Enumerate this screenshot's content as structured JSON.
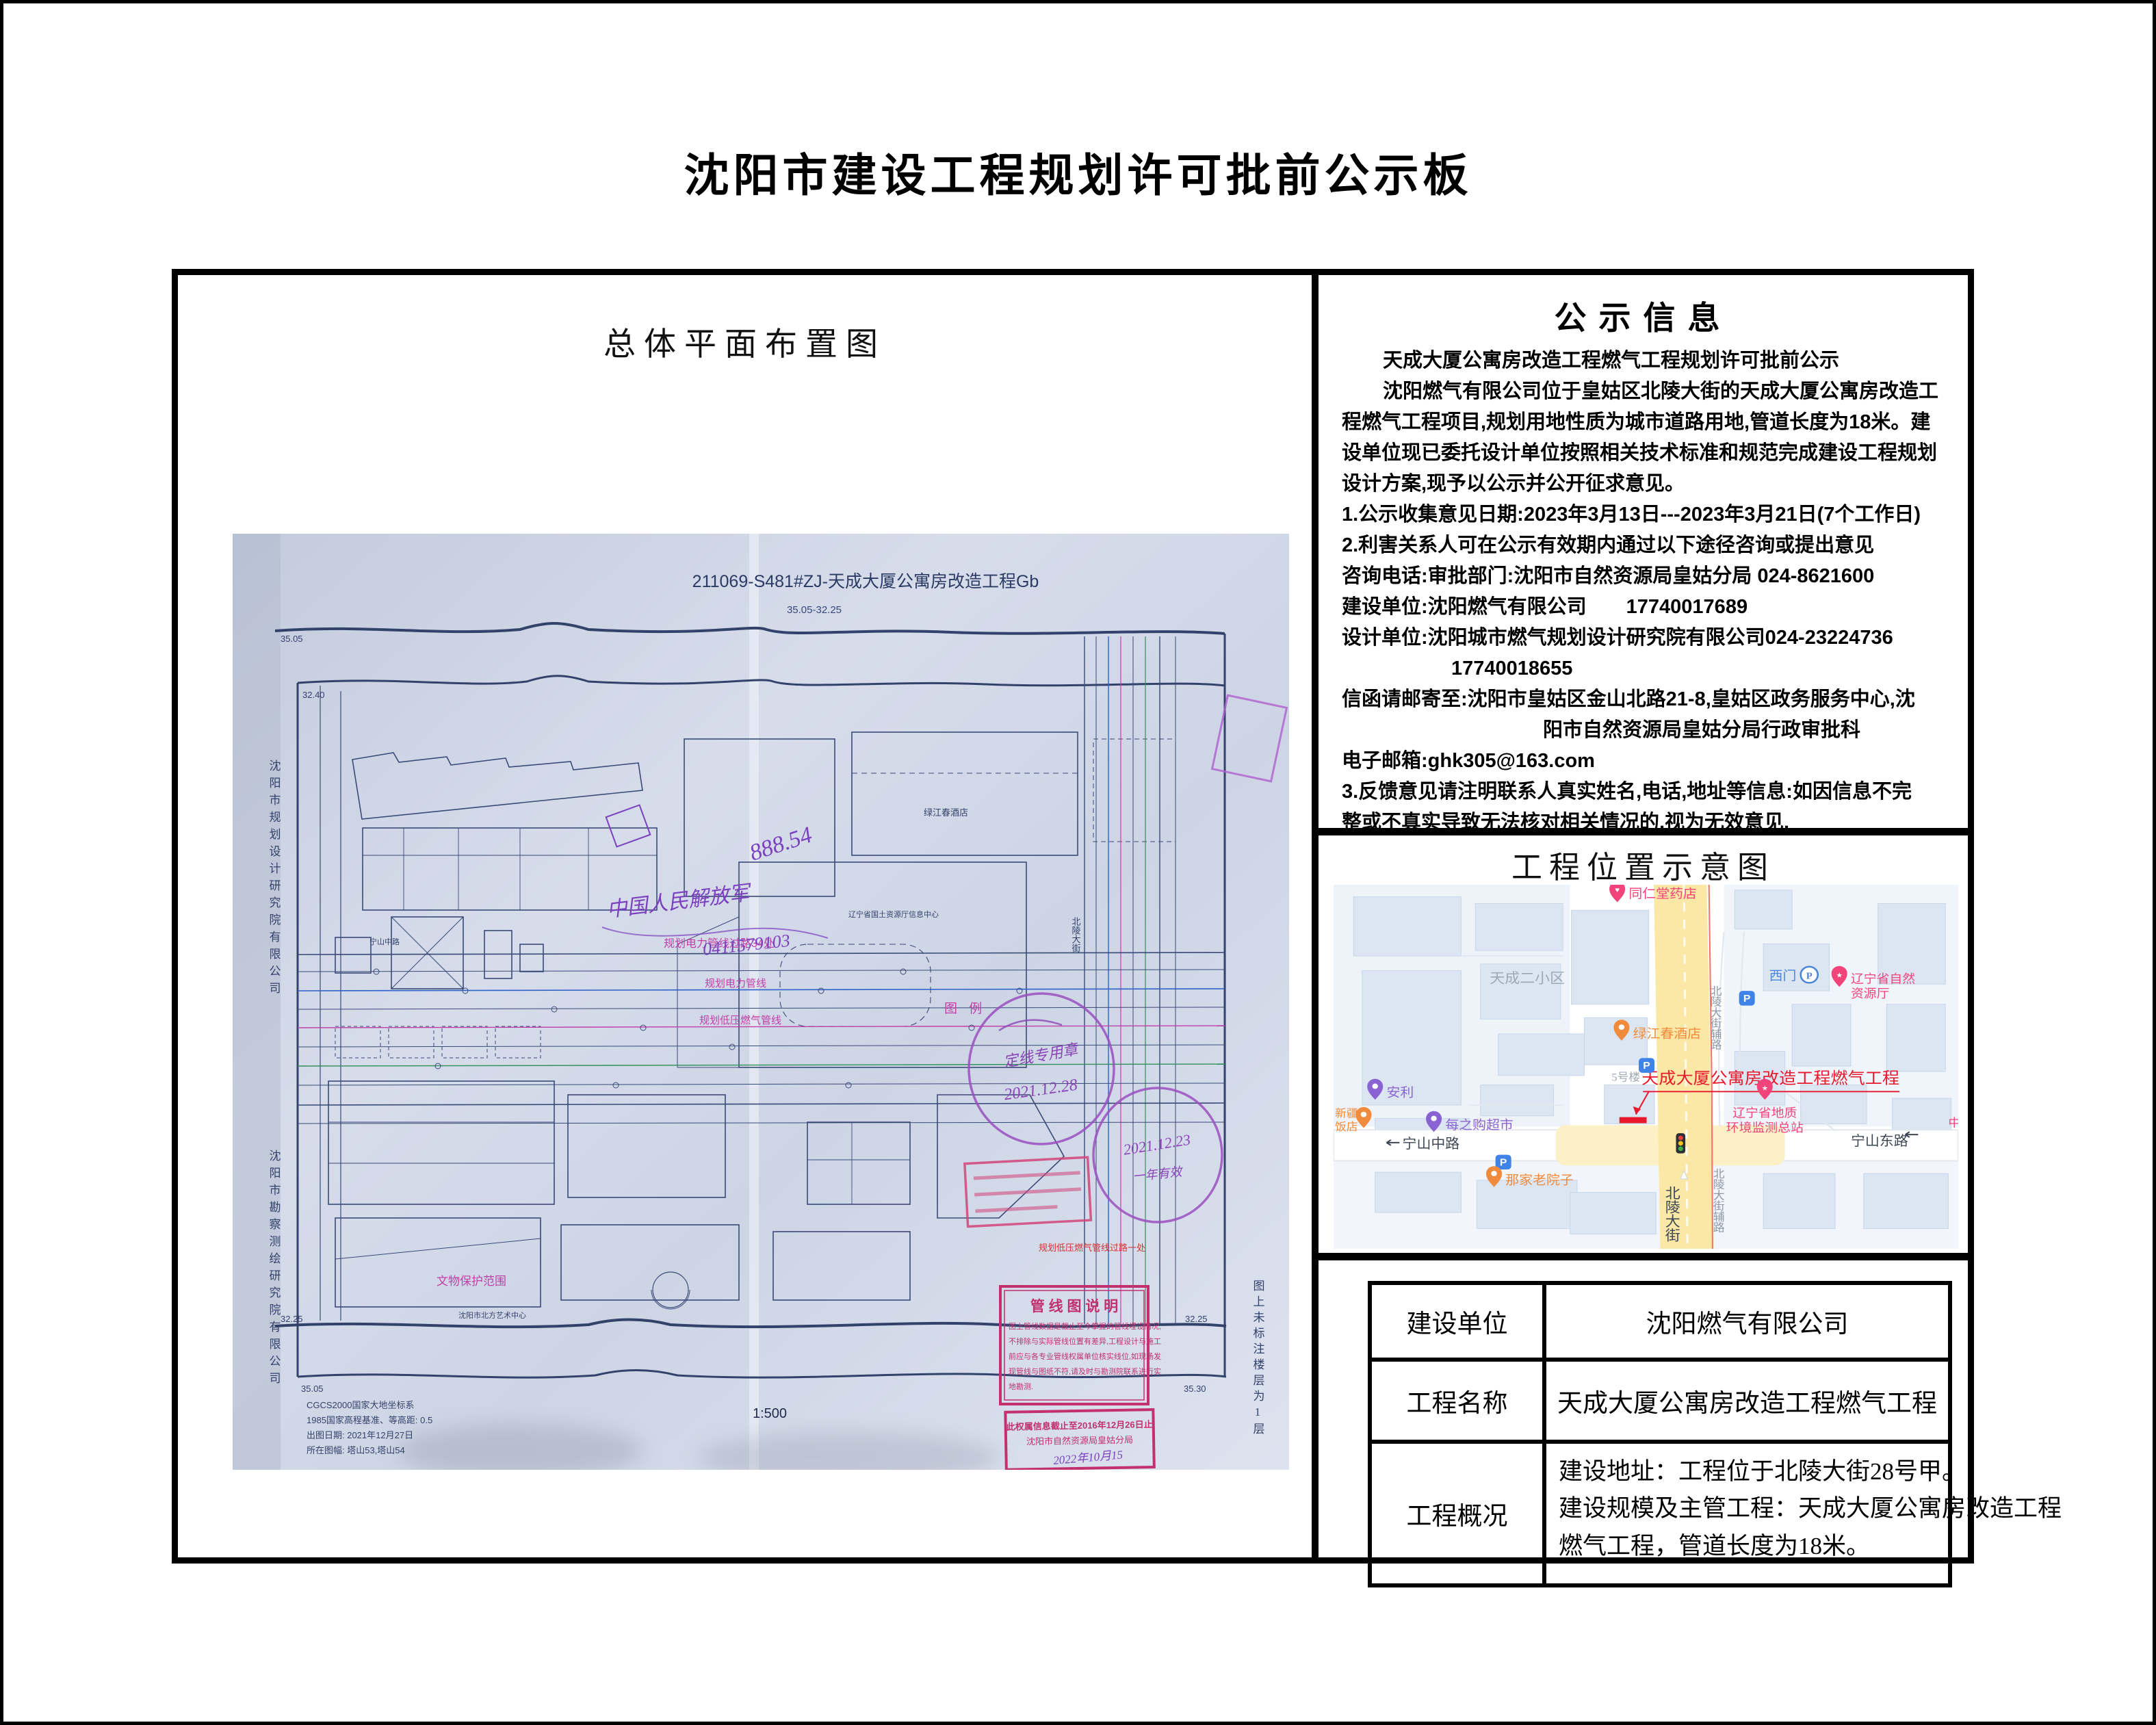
{
  "page": {
    "title": "沈阳市建设工程规划许可批前公示板"
  },
  "colors": {
    "red": "#e8192c",
    "pink": "#f2447a",
    "orange": "#f08a3c",
    "purple": "#8a63d2",
    "blue": "#3f83e8",
    "map_yellow": "#fbe8a6",
    "building_fill": "#dce6f3",
    "blueprint_ink": "#34426b",
    "stamp_magenta": "#b83aa8"
  },
  "left_panel": {
    "heading": "总体平面布置图",
    "blueprint": {
      "title": "211069-S481#ZJ-天成大厦公寓房改造工程Gb",
      "subtitle": "35.05-32.25",
      "org_left_1": "沈阳市规划设计研究院有限公司",
      "org_left_2": "沈阳市勘察测绘研究院有限公司",
      "note_right": "图上未标注楼层为1层",
      "legend": {
        "title": "管 线 图 说 明",
        "lines": [
          "图上管线数据是截止至今掌握的管线埋设情况,",
          "不排除与实际管线位置有差异,工程设计与施工",
          "前应与各专业管线权属单位核实线位,如现场发",
          "现管线与图纸不符,请及时与勘测院联系进行实",
          "地勘测."
        ]
      },
      "rights_stamp": {
        "line1": "此权属信息截止至2016年12月26日止",
        "line2": "沈阳市自然资源局皇姑分局",
        "sign": "2022年10月15"
      },
      "stamps": {
        "a_date": "2021.12.28",
        "b_date": "2021.12.23",
        "a_note": "定线专用章",
        "b_note": "一年有效"
      },
      "hand_notes": {
        "n1": "888.54",
        "n2": "中国人民解放军",
        "n3": "0411579103"
      },
      "labels": {
        "tuli": "图 例",
        "dianli_crossing": "规划电力管线过路34处",
        "dianli": "规划电力管线",
        "ranqi": "规划低压燃气管线",
        "ranqi_crossing": "规划低压燃气管线过路一处",
        "wenwu": "文物保护范围",
        "hotel": "绿江春酒店",
        "art": "沈阳市北方艺术中心",
        "info_center": "辽宁省国土资源厅信息中心",
        "road_v": "北陵大街",
        "road_h": "宁山中路"
      },
      "corners": {
        "tl1": "35.05",
        "tl2": "32.40",
        "bl1": "32.25",
        "bl2": "35.05",
        "br1": "32.25",
        "br2": "35.30"
      },
      "scale": "1:500",
      "notes": [
        "CGCS2000国家大地坐标系",
        "1985国家高程基准、等高距: 0.5",
        "出图日期: 2021年12月27日",
        "所在图幅: 塔山53,塔山54"
      ]
    }
  },
  "notice": {
    "heading": "公示信息",
    "lines": [
      {
        "text": "天成大厦公寓房改造工程燃气工程规划许可批前公示"
      },
      {
        "text": "沈阳燃气有限公司位于皇姑区北陵大街的天成大厦公寓房改造工"
      },
      {
        "text": "程燃气工程项目,规划用地性质为城市道路用地,管道长度为18米。建"
      },
      {
        "text": "设单位现已委托设计单位按照相关技术标准和规范完成建设工程规划"
      },
      {
        "text": "设计方案,现予以公示并公开征求意见。"
      },
      {
        "text": "1.公示收集意见日期:2023年3月13日---2023年3月21日(7个工作日)"
      },
      {
        "text": "2.利害关系人可在公示有效期内通过以下途径咨询或提出意见"
      },
      {
        "text": "咨询电话:审批部门:沈阳市自然资源局皇姑分局 024-8621600"
      },
      {
        "text": "建设单位:沈阳燃气有限公司　　17740017689"
      },
      {
        "text": "设计单位:沈阳城市燃气规划设计研究院有限公司024-23224736"
      },
      {
        "text": "17740018655"
      },
      {
        "text": "信函请邮寄至:沈阳市皇姑区金山北路21-8,皇姑区政务服务中心,沈"
      },
      {
        "text": "阳市自然资源局皇姑分局行政审批科"
      },
      {
        "text": "电子邮箱:ghk305@163.com"
      },
      {
        "text": "3.反馈意见请注明联系人真实姓名,电话,地址等信息:如因信息不完"
      },
      {
        "text": "整或不真实导致无法核对相关情况的,视为无效意见."
      },
      {
        "text": "4.本方案涉及的利害关系人依法享有昕证权"
      }
    ],
    "signature": {
      "org": "沈阳市自然资源局皇姑分局",
      "date": "2023年3月13日"
    }
  },
  "location": {
    "heading": "工程位置示意图",
    "map": {
      "areas": {
        "tiancheng": "天成二小区",
        "building5": "5号楼"
      },
      "roads": {
        "ningshan_mid": "宁山中路",
        "ningshan_east": "宁山东路",
        "beiling": "北陵大街",
        "beiling_fu_top": "北陵大街辅路",
        "beiling_fu_bottom": "北陵大街辅路"
      },
      "pois": {
        "pharmacy": "同仁堂药店",
        "ximen": "西门",
        "ziranting1": "辽宁省自然",
        "ziranting2": "资源厅",
        "hotel": "绿江春酒店",
        "anli": "安利",
        "xinjiang1": "新疆",
        "xinjiang2": "饭店",
        "supermarket": "每之购超市",
        "dizhi1": "辽宁省地质",
        "dizhi2": "环境监测总站",
        "yard": "那家老院子",
        "partial": "中"
      },
      "project_label": "天成大厦公寓房改造工程燃气工程",
      "parking_glyph": "P"
    }
  },
  "project_table": {
    "rows": [
      {
        "label": "建设单位",
        "value": "沈阳燃气有限公司"
      },
      {
        "label": "工程名称",
        "value": "天成大厦公寓房改造工程燃气工程"
      }
    ],
    "overview": {
      "label": "工程概况",
      "lines": [
        "建设地址：工程位于北陵大街28号甲。",
        "建设规模及主管工程：天成大厦公寓房改造工程",
        "燃气工程，管道长度为18米。"
      ]
    }
  }
}
